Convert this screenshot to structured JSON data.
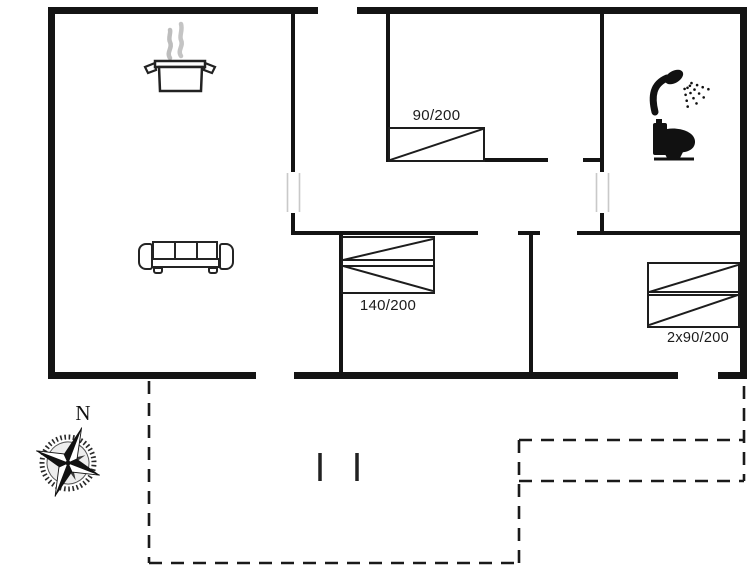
{
  "floor_plan": {
    "type": "holiday-house-floor-plan",
    "beds": {
      "single_top": "90/200",
      "double_middle": "140/200",
      "twin_right": "2x90/200"
    },
    "compass": {
      "north_label": "N"
    },
    "icons": [
      "cooking-pot-icon",
      "steam-icon",
      "sofa-icon",
      "shower-icon",
      "toilet-icon",
      "compass-rose-icon"
    ],
    "colors": {
      "wall": "#141414",
      "furniture_stroke": "#222222",
      "steam": "#bdbdbd",
      "door_jamb": "#c9c9c9",
      "background": "#ffffff"
    }
  }
}
